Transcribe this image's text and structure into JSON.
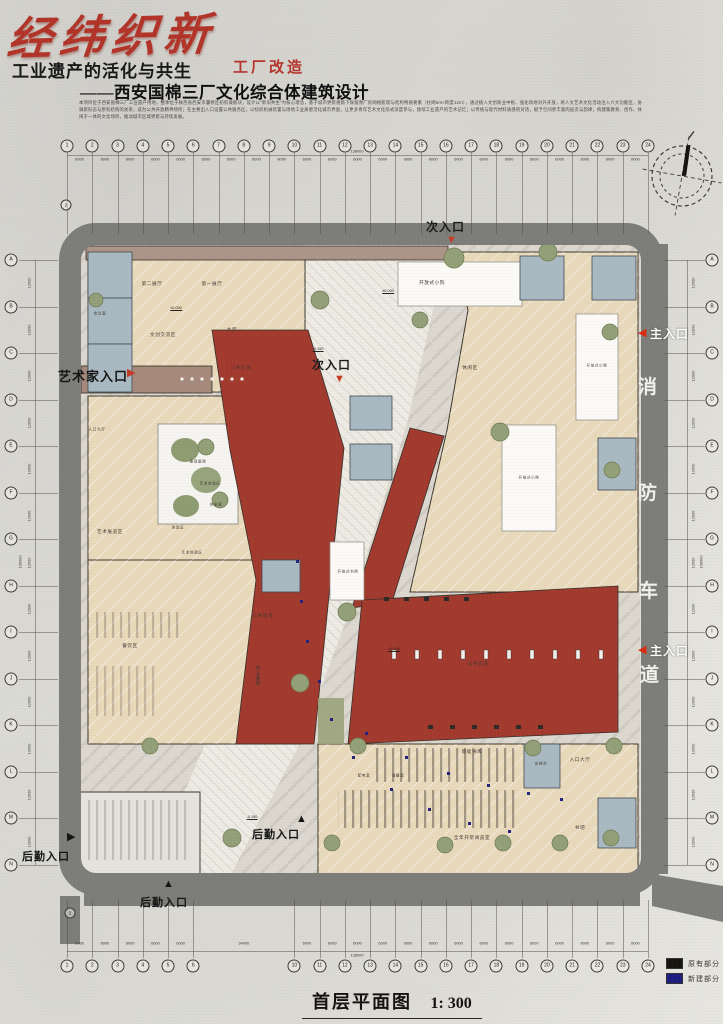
{
  "header": {
    "title": "经纬织新",
    "subtitle": "工业遗产的活化与共生",
    "tag": "工厂改造",
    "project": "——西安国棉三厂文化综合体建筑设计",
    "description": "本项目位于西安国棉三厂工业遗产用地，整体位于陕西省西安市灞桥区纺织城板块，设计以“新旧共生”为核心理念，基于城市更新视角下保留原厂房网格肌理与结构特质要素（柱网6m×跨度12m），通过植入文创商业中枢、强化场地对外开放，将人文艺术文化活动注入六大功能区，协调新形态与原有结构的关系，成为公共开放精神场所；在主要出入口设置公共服务区，以纺织机械装置与场地工业质感活化城市界面，让更多青年艺术文化形式深度参与，接续工业遗产的艺术记忆；以传统与现代材料质感的对话，赋予空间更丰富的层次与韵律，构建集教育、创作、休闲于一体的文化场所，推动城市区域更新与持续发展。"
  },
  "grid": {
    "top_cols": [
      "1",
      "2",
      "3",
      "4",
      "5",
      "6",
      "7",
      "8",
      "9",
      "10",
      "11",
      "12",
      "13",
      "14",
      "15",
      "16",
      "17",
      "18",
      "19",
      "20",
      "21",
      "22",
      "23",
      "24"
    ],
    "bottom_cols_left": [
      "1",
      "2",
      "3",
      "4",
      "5",
      "6"
    ],
    "bottom_cols_right": [
      "10",
      "11",
      "12",
      "13",
      "14",
      "15",
      "16",
      "17",
      "18",
      "19",
      "20",
      "21",
      "22",
      "23",
      "24"
    ],
    "rows": [
      "A",
      "B",
      "C",
      "D",
      "E",
      "F",
      "G",
      "H",
      "I",
      "J",
      "K",
      "L",
      "M",
      "N"
    ],
    "bay_dim": "6000",
    "row_dim": "12000",
    "total_width": "138000",
    "total_height": "156000",
    "bottom_gap_dim": "34000",
    "section_label": "2"
  },
  "plan": {
    "fire_lane_chars": [
      {
        "t": "消",
        "x": 638,
        "y": 372
      },
      {
        "t": "防",
        "x": 638,
        "y": 478
      },
      {
        "t": "车",
        "x": 639,
        "y": 576
      },
      {
        "t": "道",
        "x": 640,
        "y": 660
      }
    ],
    "rooms": [
      {
        "t": "第二展厅",
        "x": 152,
        "y": 284
      },
      {
        "t": "第一展厅",
        "x": 212,
        "y": 284
      },
      {
        "t": "大厅",
        "x": 232,
        "y": 330
      },
      {
        "t": "文创交流区",
        "x": 163,
        "y": 335
      },
      {
        "t": "会议室",
        "x": 100,
        "y": 314,
        "s": 3.6
      },
      {
        "t": "开放式小院",
        "x": 432,
        "y": 283
      },
      {
        "t": "开放式小院",
        "x": 597,
        "y": 366,
        "s": 3.6
      },
      {
        "t": "休闲区",
        "x": 470,
        "y": 368
      },
      {
        "t": "开放式小院",
        "x": 529,
        "y": 478,
        "s": 3.6
      },
      {
        "t": "开放式书吧",
        "x": 348,
        "y": 572,
        "s": 3.6
      },
      {
        "t": "入口大厅",
        "x": 97,
        "y": 430,
        "s": 3.8
      },
      {
        "t": "景观庭院",
        "x": 198,
        "y": 462,
        "s": 3.6
      },
      {
        "t": "艺术展览区",
        "x": 110,
        "y": 532
      },
      {
        "t": "艺术体验区",
        "x": 210,
        "y": 484,
        "s": 3.6
      },
      {
        "t": "休息室",
        "x": 216,
        "y": 505,
        "s": 3.6
      },
      {
        "t": "体验区",
        "x": 178,
        "y": 528,
        "s": 3.6
      },
      {
        "t": "艺术体验区",
        "x": 192,
        "y": 553,
        "s": 3.6
      },
      {
        "t": "餐饮区",
        "x": 130,
        "y": 646
      },
      {
        "t": "音乐餐吧",
        "x": 258,
        "y": 676,
        "v": true
      },
      {
        "t": "公共区域",
        "x": 241,
        "y": 368,
        "c": "#4a3630"
      },
      {
        "t": "公共区域",
        "x": 263,
        "y": 616,
        "c": "#4a3630"
      },
      {
        "t": "公共区域",
        "x": 478,
        "y": 664,
        "c": "#4a3630"
      },
      {
        "t": "基础书库",
        "x": 472,
        "y": 752
      },
      {
        "t": "出纳台",
        "x": 541,
        "y": 764,
        "s": 3.6
      },
      {
        "t": "入口大厅",
        "x": 580,
        "y": 760
      },
      {
        "t": "配电室",
        "x": 364,
        "y": 776,
        "s": 3.6
      },
      {
        "t": "储藏室",
        "x": 398,
        "y": 776,
        "s": 3.6
      },
      {
        "t": "全年开架阅览室",
        "x": 472,
        "y": 838
      },
      {
        "t": "书吧",
        "x": 580,
        "y": 828
      }
    ],
    "marks": [
      {
        "t": "±0.000",
        "x": 176,
        "y": 311
      },
      {
        "t": "-0.150",
        "x": 318,
        "y": 352
      },
      {
        "t": "±0.000",
        "x": 388,
        "y": 294
      },
      {
        "t": "±0.000",
        "x": 394,
        "y": 652
      },
      {
        "t": "-0.150",
        "x": 252,
        "y": 820
      }
    ],
    "entrances": [
      {
        "t": "次入口",
        "x": 426,
        "y": 218,
        "fs": 12,
        "tc": "#1b1b1b",
        "arrow": "▼",
        "ac": "#c63b22",
        "ax": 446,
        "ay": 235
      },
      {
        "t": "次入口",
        "x": 312,
        "y": 356,
        "fs": 12,
        "tc": "#1b1b1b",
        "arrow": "▼",
        "ac": "#c63b22",
        "ax": 334,
        "ay": 374
      },
      {
        "t": "主入口",
        "x": 650,
        "y": 325,
        "fs": 12,
        "tc": "#ffffff",
        "arrow": "◀",
        "ac": "#d92b12",
        "ax": 638,
        "ay": 328
      },
      {
        "t": "主入口",
        "x": 650,
        "y": 642,
        "fs": 12,
        "tc": "#ffffff",
        "arrow": "◀",
        "ac": "#d92b12",
        "ax": 638,
        "ay": 645
      },
      {
        "t": "艺术家入口",
        "x": 58,
        "y": 366,
        "fs": 13,
        "tc": "#141414",
        "arrow": "▶",
        "ac": "#c63b22",
        "ax": 127,
        "ay": 368
      },
      {
        "t": "后勤入口",
        "x": 22,
        "y": 848,
        "fs": 11,
        "tc": "#141414",
        "arrow": "▶",
        "ac": "#141414",
        "ax": 67,
        "ay": 832
      },
      {
        "t": "后勤入口",
        "x": 252,
        "y": 826,
        "fs": 11,
        "tc": "#141414",
        "arrow": "▲",
        "ac": "#141414",
        "ax": 296,
        "ay": 814
      },
      {
        "t": "后勤入口",
        "x": 140,
        "y": 894,
        "fs": 11,
        "tc": "#141414",
        "arrow": "▲",
        "ac": "#141414",
        "ax": 163,
        "ay": 879
      }
    ]
  },
  "legend": {
    "items": [
      {
        "label": "原有部分",
        "color": "#15140f"
      },
      {
        "label": "新建部分",
        "color": "#1d1d80"
      }
    ]
  },
  "caption": {
    "title": "首层平面图",
    "scale": "1: 300"
  },
  "colors": {
    "new_red": "#a23a2e",
    "road_gray": "#7d7d79",
    "existing_beige": "#e9d9bb",
    "utility_blue": "#a9b9c2"
  }
}
